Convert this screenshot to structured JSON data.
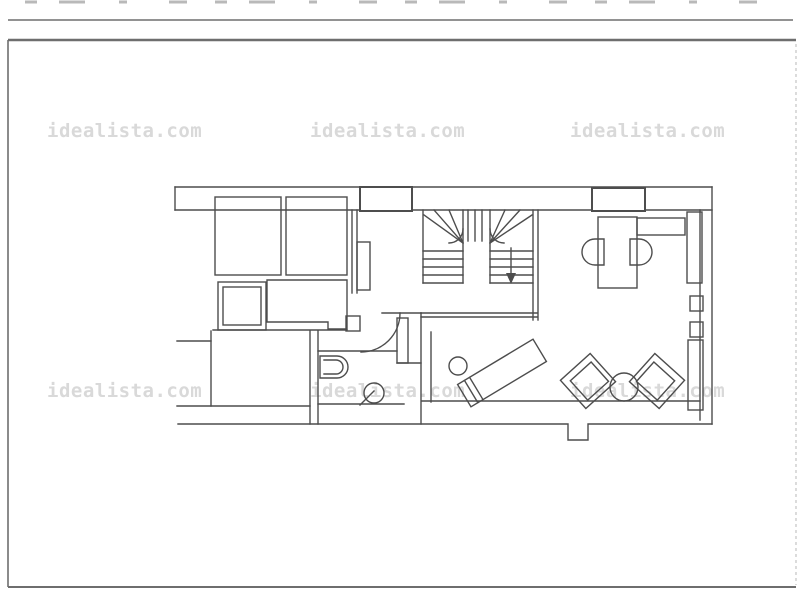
{
  "watermark": {
    "text": "idealista.com",
    "color": "#d9d9d9",
    "count": 6
  },
  "floor_plan": {
    "line_color": "#4d4d4d",
    "frame_color": "#6e6e6e",
    "background": "#ffffff"
  }
}
